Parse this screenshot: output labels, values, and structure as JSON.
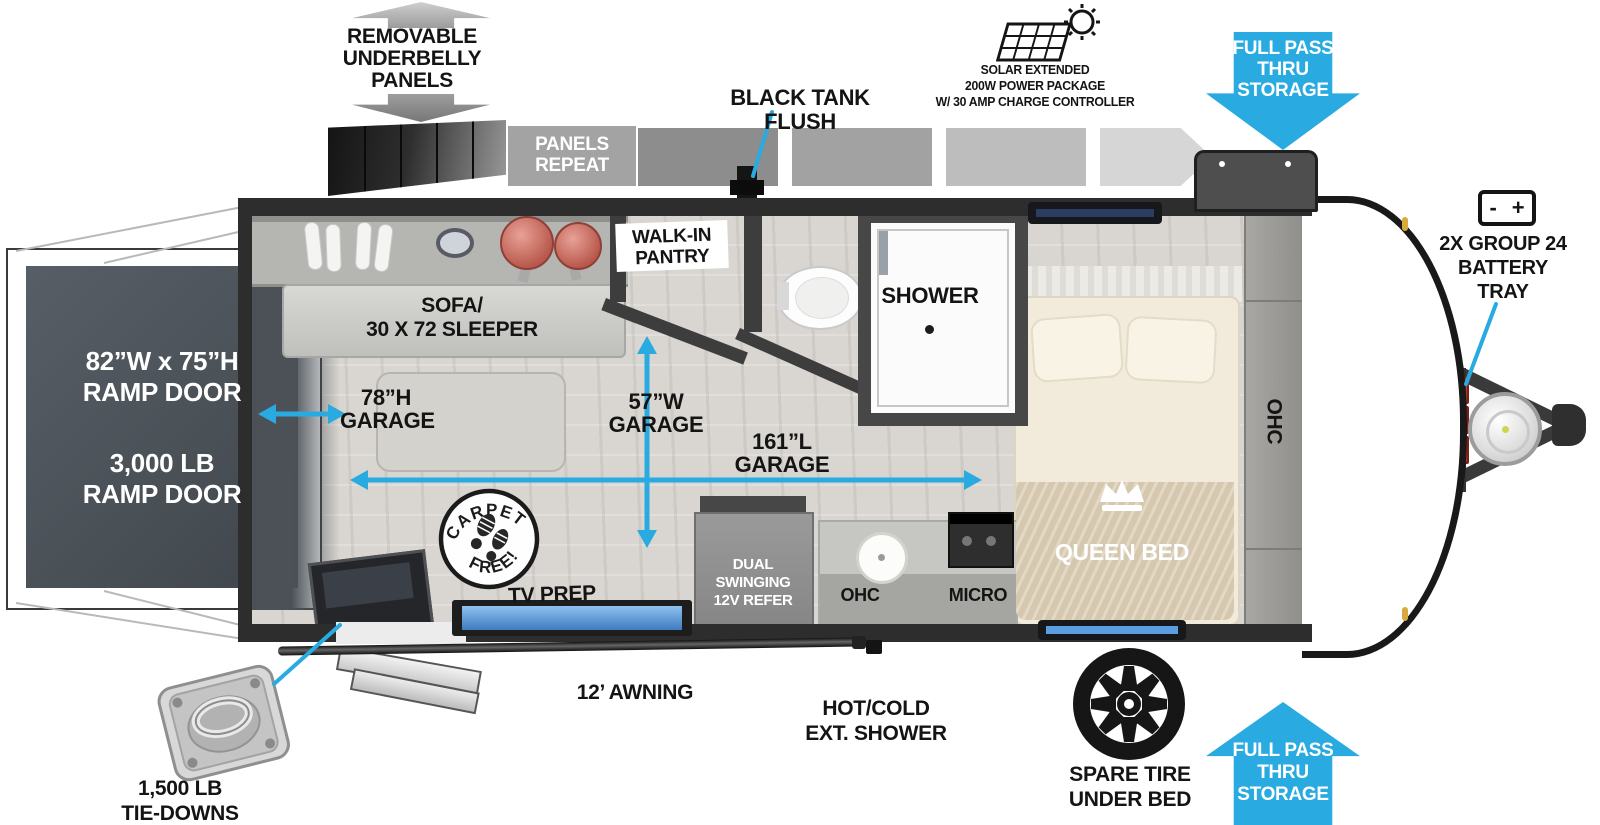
{
  "colors": {
    "accent": "#29ABE2",
    "wall": "#2d2d2d",
    "label": "#141414"
  },
  "top": {
    "underbelly": {
      "label": "REMOVABLE\nUNDERBELLY\nPANELS"
    },
    "panels_repeat": {
      "label": "PANELS\nREPEAT"
    },
    "black_tank_flush": {
      "label": "BLACK TANK FLUSH"
    },
    "solar": {
      "label": "SOLAR EXTENDED\n200W POWER PACKAGE\nW/ 30 AMP CHARGE CONTROLLER"
    },
    "full_pass_thru": {
      "label": "FULL PASS\nTHRU\nSTORAGE"
    },
    "battery": {
      "minus": "-",
      "plus": "+",
      "label": "2X GROUP 24\nBATTERY\nTRAY"
    }
  },
  "ramp": {
    "size": "82”W x 75”H\nRAMP DOOR",
    "weight": "3,000 LB\nRAMP DOOR"
  },
  "interior": {
    "sofa": "SOFA/\n30 X 72 SLEEPER",
    "pantry": "WALK-IN\nPANTRY",
    "shower": "SHOWER",
    "garage_height": "78”H\nGARAGE",
    "garage_width": "57”W\nGARAGE",
    "garage_length": "161”L\nGARAGE",
    "queen_bed": "QUEEN BED",
    "ohc_bedroom": "OHC",
    "carpet_free": {
      "top": "CARPET",
      "bottom": "FREE!"
    },
    "tv_prep": "TV PREP",
    "refer": "DUAL SWINGING\n12V REFER",
    "ohc_kitchen": "OHC",
    "micro": "MICRO"
  },
  "bottom": {
    "tie_downs": "1,500 LB\nTIE-DOWNS",
    "awning": "12’ AWNING",
    "ext_shower": "HOT/COLD\nEXT. SHOWER",
    "spare_tire": "SPARE TIRE\nUNDER BED",
    "full_pass_thru": "FULL PASS\nTHRU\nSTORAGE"
  }
}
